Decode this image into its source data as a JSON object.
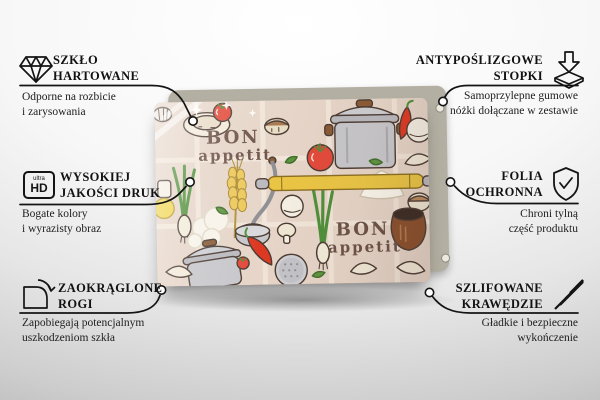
{
  "product": {
    "artwork_text": {
      "line1": "BON",
      "line2": "appetit"
    }
  },
  "features": [
    {
      "id": "szklo-hartowane",
      "icon": "diamond-icon",
      "title_line1": "SZKŁO",
      "title_line2": "HARTOWANE",
      "desc_line1": "Odporne na rozbicie",
      "desc_line2": "i zarysowania"
    },
    {
      "id": "wysokiej-jakosci-druk",
      "icon": "ultra-hd-icon",
      "icon_text_top": "ultra",
      "icon_text_bottom": "HD",
      "title_line1": "WYSOKIEJ",
      "title_line2": "JAKOŚCI DRUK",
      "desc_line1": "Bogate kolory",
      "desc_line2": "i wyrazisty obraz"
    },
    {
      "id": "zaokraglone-rogi",
      "icon": "rounded-corner-icon",
      "title_line1": "ZAOKRĄGLONE",
      "title_line2": "ROGI",
      "desc_line1": "Zapobiegają potencjalnym",
      "desc_line2": "uszkodzeniom szkła"
    },
    {
      "id": "antyposlizgowe-stopki",
      "icon": "anti-slip-feet-icon",
      "title_line1": "ANTYPOŚLIZGOWE",
      "title_line2": "STOPKI",
      "desc_line1": "Samoprzylepne gumowe",
      "desc_line2": "nóżki dołączane w zestawie"
    },
    {
      "id": "folia-ochronna",
      "icon": "shield-check-icon",
      "title_line1": "FOLIA",
      "title_line2": "OCHRONNA",
      "desc_line1": "Chroni tylną",
      "desc_line2": "część produktu"
    },
    {
      "id": "szlifowane-krawedzie",
      "icon": "polished-edges-icon",
      "title_line1": "SZLIFOWANE",
      "title_line2": "KRAWĘDZIE",
      "desc_line1": "Gładkie i bezpieczne",
      "desc_line2": "wykończenie"
    }
  ],
  "colors": {
    "connector_line": "#141414",
    "board_background": "#e6d5c8",
    "board_grid": "#f2e7da",
    "backing_panel": "#b3afa2",
    "artwork_text_brown": "#6b5046",
    "accent_red": "#df4433",
    "accent_yellow": "#eac544",
    "pot_grey": "#c7c7cb"
  }
}
